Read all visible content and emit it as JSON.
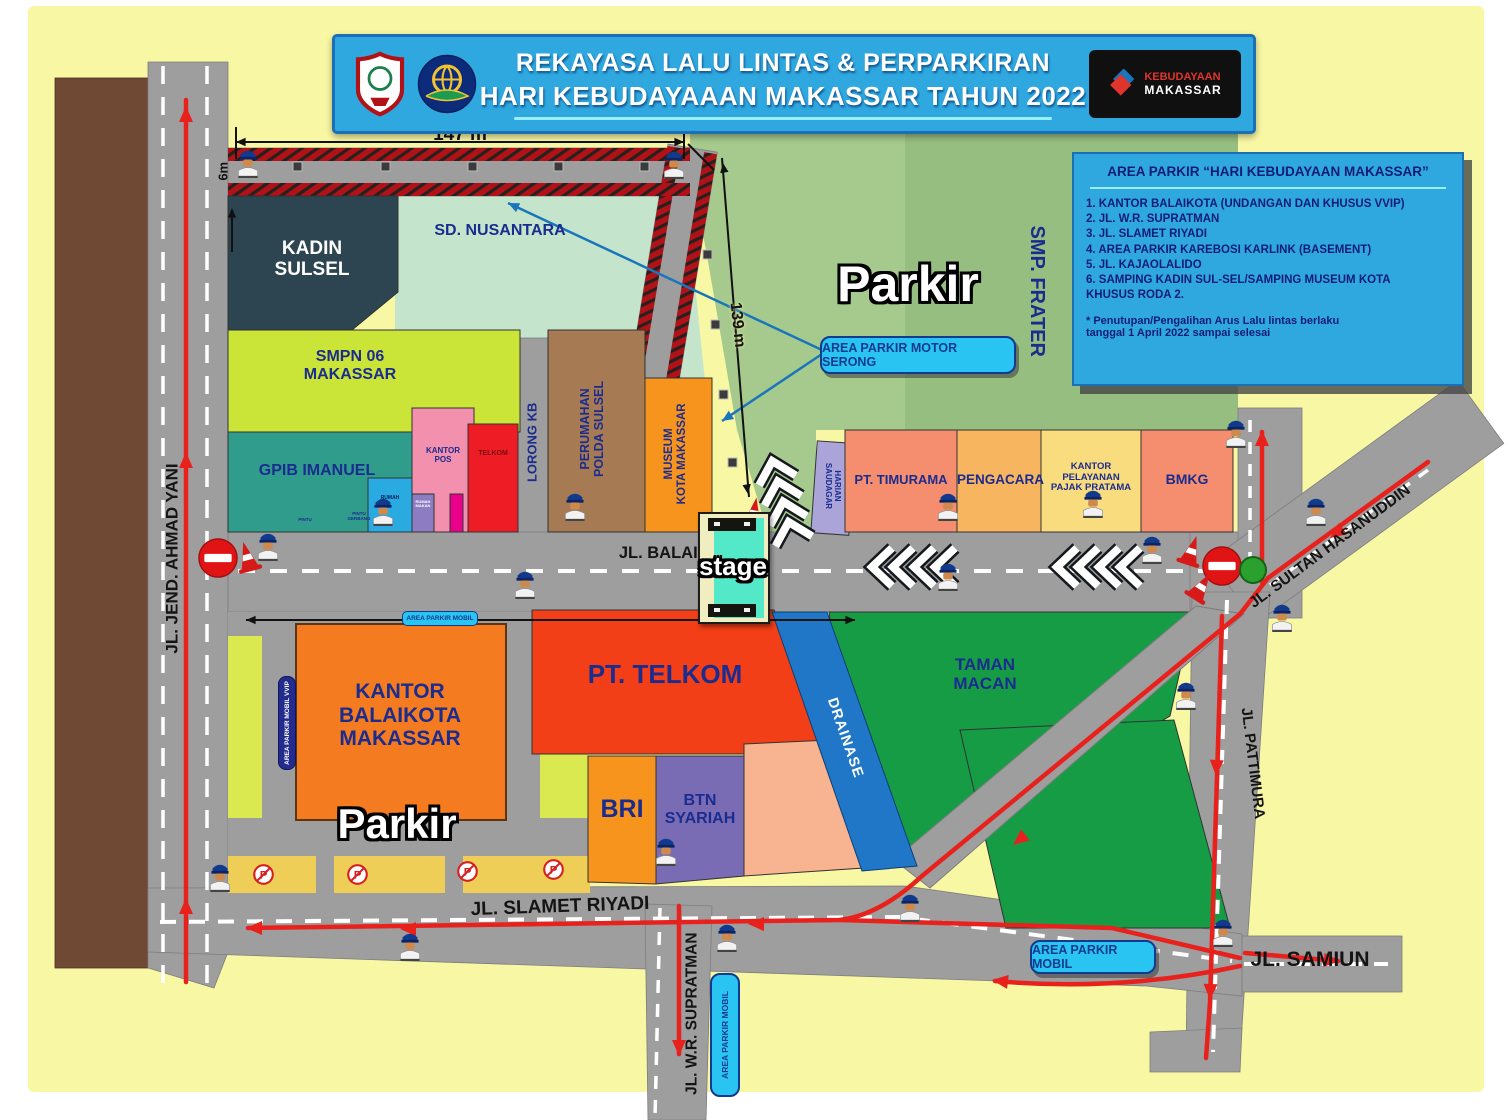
{
  "banner": {
    "line1": "REKAYASA LALU LINTAS & PERPARKIRAN",
    "line2": "HARI KEBUDAYAAAN MAKASSAR TAHUN 2022",
    "badge_line1": "KEBUDAYAAN",
    "badge_line2": "MAKASSAR"
  },
  "info_box": {
    "title": "AREA PARKIR “HARI KEBUDAYAAN MAKASSAR”",
    "items": [
      "1. KANTOR BALAIKOTA  (UNDANGAN DAN KHUSUS VVIP)",
      "2. JL. W.R. SUPRATMAN",
      "3. JL. SLAMET RIYADI",
      "4. AREA PARKIR KAREBOSI KARLINK (BASEMENT)",
      "5. JL. KAJAOLALIDO",
      "6. SAMPING KADIN SUL-SEL/SAMPING MUSEUM KOTA\n      KHUSUS RODA 2."
    ],
    "footnote": "* Penutupan/Pengalihan Arus Lalu lintas berlaku\n   tanggal 1 April 2022 sampai selesai"
  },
  "streets": {
    "ahmad_yani": "JL. JEND. AHMAD YANI",
    "balaikota": "JL. BALAIKOTA",
    "slamet_riyadi": "JL. SLAMET RIYADI",
    "wr_supratman": "JL. W.R. SUPRATMAN",
    "samiun": "JL. SAMIUN",
    "pattimura": "JL. PATTIMURA",
    "sultan_hasanuddin": "JL. SULTAN HASANUDDIN",
    "lorong_kb": "LORONG KB"
  },
  "buildings": {
    "kadin": "KADIN\nSULSEL",
    "sd_nusantara": "SD. NUSANTARA",
    "smpn": "SMPN 06\nMAKASSAR",
    "gpib": "GPIB IMANUEL",
    "kantor_pos": "KANTOR\nPOS",
    "telkom_small": "TELKOM",
    "rumah_blue": "RUMAH",
    "rumah_makan": "RUMAH\nMAKAN",
    "pintu": "PINTU",
    "pintu_gerbang": "PINTU\nGERBANG",
    "perumahan": "PERUMAHAN\nPOLDA SULSEL",
    "museum": "MUSEUM\nKOTA MAKASSAR",
    "smp_frater": "SMP. FRATER",
    "harian_saudagar": "HARIAN\nSAUDAGAR",
    "pt_timurama": "PT. TIMURAMA",
    "pengacara": "PENGACARA",
    "pajak": "KANTOR\nPELAYANAN\nPAJAK PRATAMA",
    "bmkg": "BMKG",
    "balaikota_office": "KANTOR\nBALAIKOTA\nMAKASSAR",
    "pt_telkom": "PT. TELKOM",
    "bri": "BRI",
    "btn": "BTN\nSYARIAH",
    "drainase": "DRAINASE",
    "taman_macan": "TAMAN\nMACAN"
  },
  "labels": {
    "parkir": "Parkir",
    "stage": "stage",
    "motor_serong": "AREA PARKIR MOTOR SERONG",
    "mobil": "AREA PARKIR MOBIL",
    "mobil_vvip": "AREA PARKIR MOBIL VVIP"
  },
  "dimensions": {
    "d147": "147 m",
    "d6": "6m",
    "d139": "139 m",
    "d360": "360 m"
  },
  "icons": {
    "p": "P"
  },
  "colors": {
    "banner_blue": "#2FA8E0",
    "label_cyan": "#2AC4F3",
    "navy_text": "#1B2C8F",
    "road_gray": "#9E9E9E",
    "route_red": "#E8211D",
    "park_green": "#159C45",
    "field_green": "#A6CA8D",
    "bg_yellow": "#F8F8A4"
  }
}
